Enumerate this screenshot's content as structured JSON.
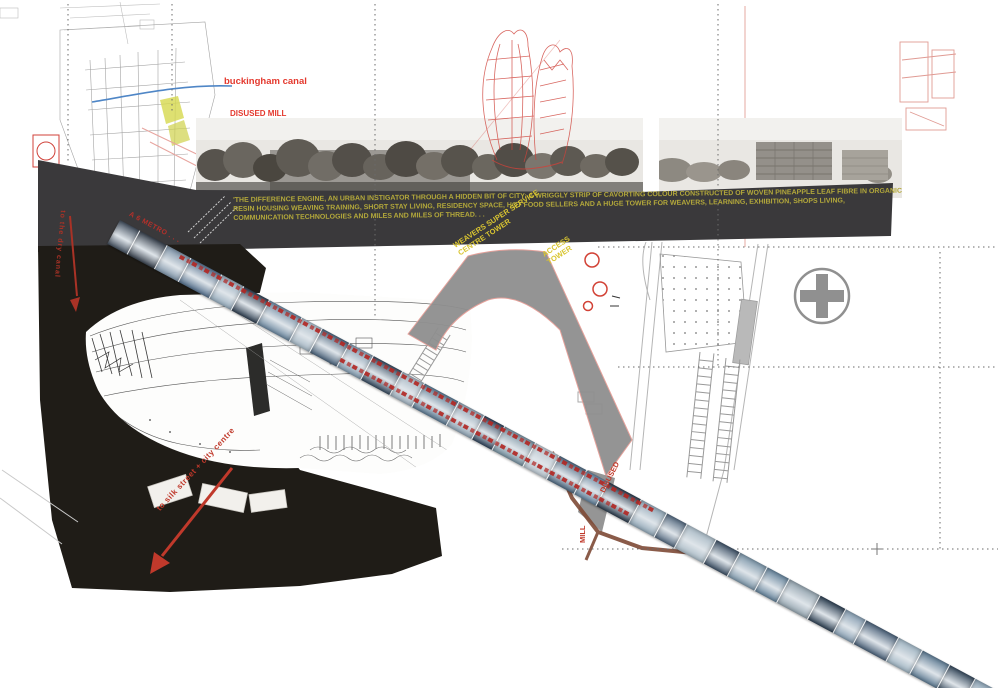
{
  "banner": {
    "lines": [
      "'THE DIFFERENCE ENGINE, AN URBAN INSTIGATOR THROUGH A HIDDEN BIT OF CITY: A WRIGGLY STRIP OF CAVORTING COLOUR CONSTRUCTED OF WOVEN PINEAPPLE LEAF FIBRE IN ORGANIC",
      "RESIN HOUSING WEAVING TRAINING, SHORT STAY LIVING, RESIDENCY SPACE, HOT FOOD SELLERS AND A HUGE TOWER FOR WEAVERS, LEARNING, EXHIBITION, SHOPS LIVING,",
      "COMMUNICATION TECHNOLOGIES AND MILES AND MILES OF THREAD. . ."
    ]
  },
  "map": {
    "canal_label": "buckingham canal",
    "mill_label": "DISUSED MILL"
  },
  "annotations": {
    "metro": "A 6 METRO . . .",
    "weavers_line1": "WEAVERS SUPER SERVICE",
    "weavers_line2": "CENTRE TOWER",
    "access_line1": "ACCESS",
    "access_line2": "TOWER",
    "dry_canal": "to the dry canal",
    "silk_street": "to silk street + city centre",
    "disused": "DISUSED",
    "mill": "MILL"
  },
  "colors": {
    "banner-bg": "#3a393b",
    "banner-text": "#b3a83b",
    "annotation-red": "#c0392b",
    "map-red": "#e4392e",
    "tower-yellow": "#d9c531",
    "black-region": "#1f1c17",
    "strip-red": "#b5302a"
  },
  "strip": {
    "segment_colors": [
      "#44505f",
      "#39424e",
      "#7e93a7",
      "#55708d",
      "#94aabb",
      "#2f3f51",
      "#69859d",
      "#a4b6c3",
      "#4b637b",
      "#8199ad",
      "#364a5f",
      "#a0b1be",
      "#5a7890",
      "#8ea2b2",
      "#30435a",
      "#76909f",
      "#b7c3cc",
      "#4e6880",
      "#62809a",
      "#2b3a4b",
      "#90a6b6",
      "#53687e",
      "#a8b9c4",
      "#3d5065",
      "#7b95a8",
      "#65839b",
      "#93a3ae",
      "#2e4053",
      "#859cb0",
      "#4a6078",
      "#9eb3c1",
      "#5d7a92",
      "#36495c",
      "#8aa1b3"
    ],
    "segment_widths": [
      22,
      30,
      26,
      34,
      24,
      28,
      36,
      22,
      30,
      26,
      32,
      24,
      38,
      28,
      22,
      34,
      26,
      30,
      24,
      36,
      28,
      22,
      32,
      26,
      30,
      24,
      34,
      28,
      22,
      36,
      26,
      30,
      28,
      24
    ]
  }
}
